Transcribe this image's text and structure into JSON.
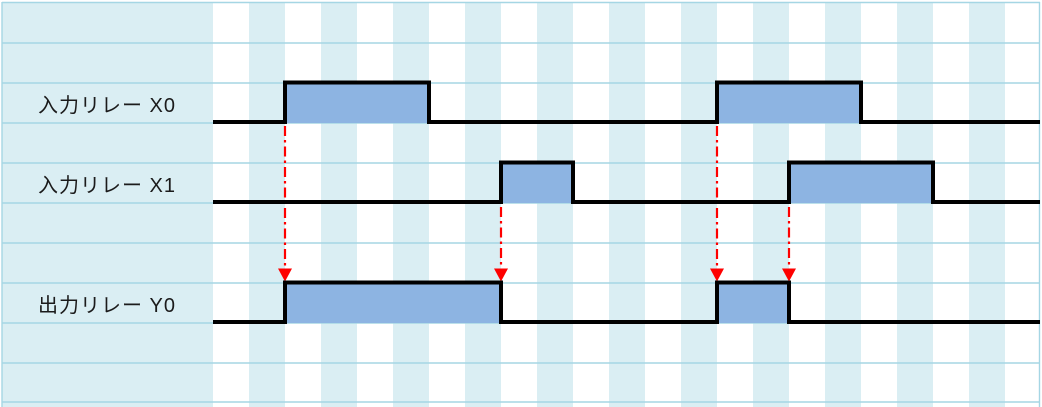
{
  "diagram": {
    "title": "PLC relay timing chart",
    "canvas": {
      "width_px": 1042,
      "height_px": 407
    },
    "colors": {
      "page_white": "#ffffff",
      "sheet_light_blue": "#daeef3",
      "gridline": "#a5d6e4",
      "pulse_fill": "#8db4e2",
      "waveform_stroke": "#000000",
      "arrow_red": "#fe0000",
      "label_text": "#1b1b1b"
    },
    "sheet": {
      "content_left_x": 2,
      "content_right_x": 1039,
      "content_top_y": 3,
      "stripe_start_x": 213,
      "stripe_width": 36,
      "stripe_count": 23,
      "h_gridlines_y": [
        2.5,
        43,
        83,
        123,
        163,
        203,
        243,
        283,
        323,
        363,
        402
      ],
      "v_gridlines_x": [
        2,
        1039.5
      ]
    },
    "waveform_style": {
      "stroke_width": 4
    },
    "signals": [
      {
        "id": "x0",
        "label": "入力リレー X0",
        "kind": "input-relay",
        "high_y": 82.5,
        "low_y": 122,
        "fill_bottom_y": 123,
        "baseline_start_x": 213,
        "baseline_end_x": 1040,
        "pulses": [
          {
            "start_x": 285,
            "end_x": 429
          },
          {
            "start_x": 717,
            "end_x": 861
          }
        ]
      },
      {
        "id": "x1",
        "label": "入力リレー X1",
        "kind": "input-relay",
        "high_y": 162.5,
        "low_y": 202,
        "fill_bottom_y": 203,
        "baseline_start_x": 213,
        "baseline_end_x": 1040,
        "pulses": [
          {
            "start_x": 501,
            "end_x": 573
          },
          {
            "start_x": 789,
            "end_x": 933
          }
        ]
      },
      {
        "id": "y0",
        "label": "出力リレー Y0",
        "kind": "output-relay",
        "high_y": 282.5,
        "low_y": 322,
        "fill_bottom_y": 323,
        "baseline_start_x": 213,
        "baseline_end_x": 1040,
        "pulses": [
          {
            "start_x": 285,
            "end_x": 501
          },
          {
            "start_x": 717,
            "end_x": 789
          }
        ]
      }
    ],
    "arrows": [
      {
        "x": 285,
        "start_y": 126,
        "tip_y": 281.5
      },
      {
        "x": 501,
        "start_y": 207,
        "tip_y": 281.5
      },
      {
        "x": 717,
        "start_y": 126,
        "tip_y": 281.5
      },
      {
        "x": 789,
        "start_y": 207,
        "tip_y": 281.5
      }
    ],
    "arrow_style": {
      "dasharray": "10 4 2.5 4",
      "stroke_width": 2.2,
      "head_width": 14,
      "head_height": 13
    }
  }
}
